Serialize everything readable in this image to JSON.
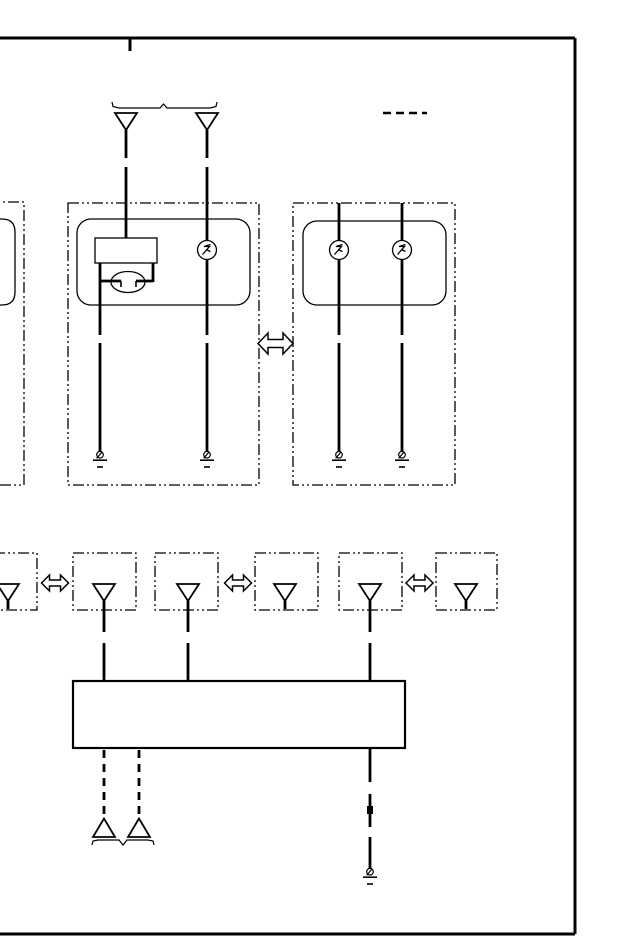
{
  "page": {
    "type": "service-manual-wiring-diagram",
    "background": "#ffffff",
    "ink": "#000000",
    "width": 640,
    "height": 950
  },
  "frame": {
    "sides_visible": [
      "top",
      "right",
      "bottom"
    ],
    "left_edge": "cropped",
    "section_tick": 1
  },
  "symbols": {
    "male_connector_down": "outlined triangle pointing down",
    "male_connector_up": "outlined triangle pointing up",
    "bulb": "circle with filament squiggle",
    "dual_filament_bulb": "ellipse with two electrode leads under socket rectangle",
    "ground": "bolt circle over two horizontal bars",
    "harness_continuation": "outlined double-headed arrow",
    "component_enclosure": "dash-dot-dot rounded/dashed box",
    "splice": "small filled square on wire",
    "brace": "thin bracket with center notch",
    "note_line": "short dashed horizontal segment"
  },
  "counts": {
    "top_connector_triangles": 2,
    "component_boxes_upper": 3,
    "bulb_circles": 3,
    "dual_filament_bulbs": 1,
    "grounds_upper": 4,
    "grounds_lower": 1,
    "double_arrows_large": 1,
    "double_arrows_small": 3,
    "inline_connector_boxes": 6,
    "inline_connector_triangles": 6,
    "junction_rectangles": 1,
    "dashed_leads_bottom": 2,
    "bottom_up_triangles": 2,
    "splices": 1
  }
}
